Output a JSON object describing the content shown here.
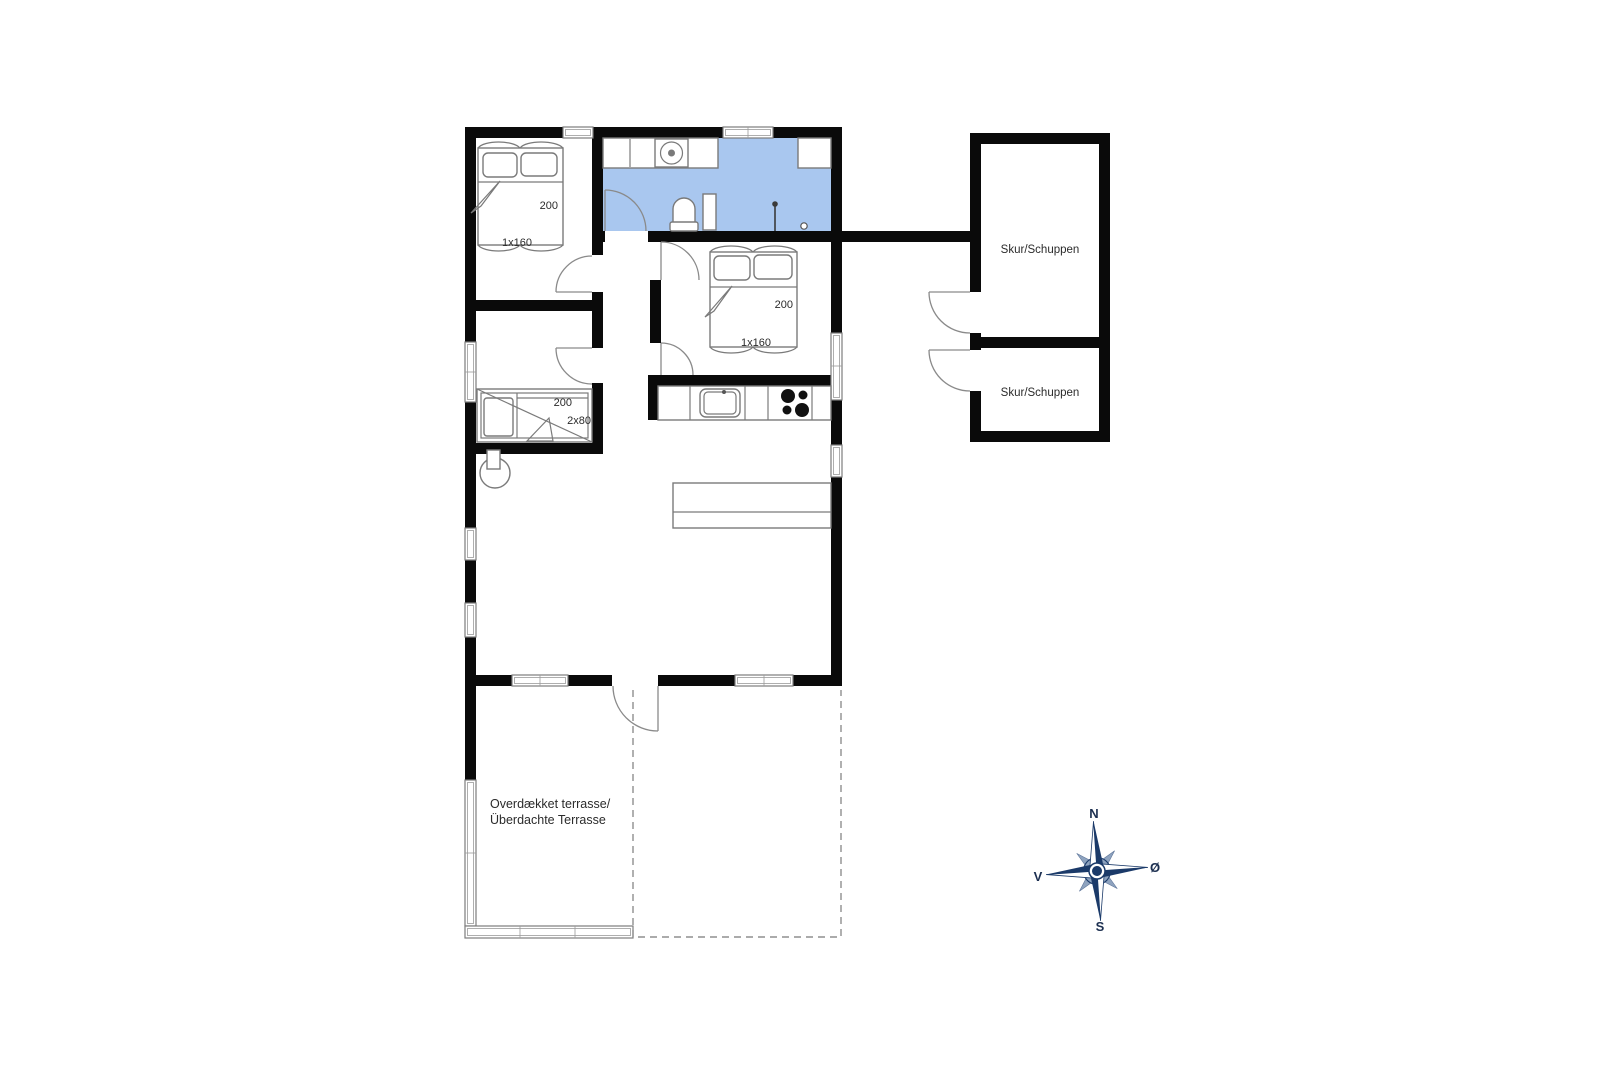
{
  "colors": {
    "wall": "#0a0a0a",
    "bathroom_floor": "#a9c7ef",
    "furniture_line": "#7a7a7a",
    "compass_navy": "#1b3a69",
    "text": "#2b2b2b"
  },
  "rooms": {
    "bedroom1": {
      "bed_length_label": "200",
      "bed_size_label": "1x160"
    },
    "bedroom2": {
      "bed_length_label": "200",
      "bed_size_label": "1x160"
    },
    "bunkroom": {
      "bed_length_label": "200",
      "bed_size_label": "2x80"
    },
    "shed1": {
      "label": "Skur/Schuppen"
    },
    "shed2": {
      "label": "Skur/Schuppen"
    },
    "terrace": {
      "label_line1": "Overdækket terrasse/",
      "label_line2": "Überdachte Terrasse"
    }
  },
  "compass": {
    "north": "N",
    "south": "S",
    "west": "V",
    "east": "Ø"
  }
}
